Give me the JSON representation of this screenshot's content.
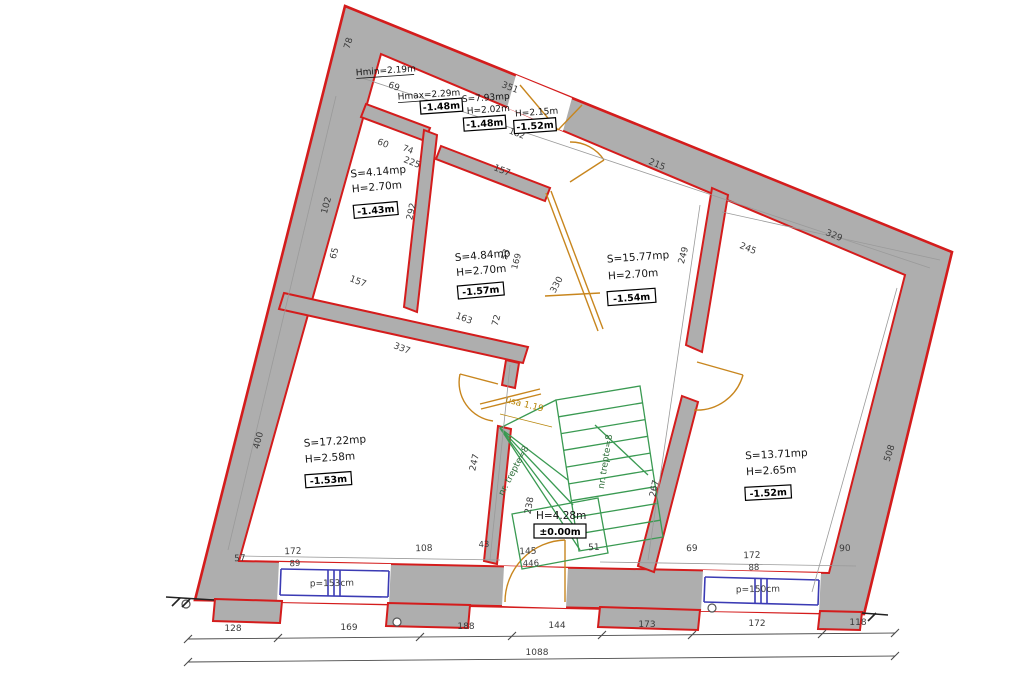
{
  "colors": {
    "wall_fill": "#aeaeae",
    "wall_outline": "#d41c1c",
    "stairs": "#3a9a52",
    "doors": "#c8861e",
    "windows": "#3b3bb4",
    "dimensions": "#3b3b3b"
  },
  "rooms": {
    "corridor": {
      "hmin": "Hmin=2.19m",
      "hmax": "Hmax=2.29m",
      "level_a": "-1.48m",
      "area": "S=7.93mp",
      "height": "H=2.02m",
      "level_b": "-1.48m",
      "height_b": "H=2.15m",
      "level_c": "-1.52m"
    },
    "small_left": {
      "area": "S=4.14mp",
      "height": "H=2.70m",
      "level": "-1.43m"
    },
    "small_mid": {
      "area": "S=4.84mp",
      "height": "H=2.70m",
      "level": "-1.57m"
    },
    "center": {
      "area": "S=15.77mp",
      "height": "H=2.70m",
      "level": "-1.54m"
    },
    "big_left": {
      "area": "S=17.22mp",
      "height": "H=2.58m",
      "level": "-1.53m"
    },
    "big_right": {
      "area": "S=13.71mp",
      "height": "H=2.65m",
      "level": "-1.52m"
    }
  },
  "stairs": {
    "treads_label_a": "nr. trepte=8",
    "treads_label_b": "nr. trepte=8",
    "height": "H=4.28m",
    "level": "±0.00m",
    "door_label": "usa 1.19"
  },
  "windows": {
    "left_parapet": "p=153cm",
    "right_parapet": "p=150cm"
  },
  "dim_chain_bottom": {
    "segments": [
      "128",
      "169",
      "188",
      "144",
      "173",
      "172",
      "118"
    ],
    "total": "1088"
  },
  "dims": {
    "t78": "78",
    "t69": "69",
    "t351": "351",
    "t60": "60",
    "t74": "74",
    "t225": "225",
    "t157_top": "157",
    "t182": "182",
    "t215": "215",
    "t245": "245",
    "t329": "329",
    "l102": "102",
    "l65": "65",
    "l292": "292",
    "l400": "400",
    "m157_bottom": "157",
    "m337": "337",
    "m247": "247",
    "m163": "163",
    "m72": "72",
    "m53": "53",
    "m169": "169",
    "m330": "330",
    "m238": "238",
    "m249": "249",
    "m267": "267",
    "r508": "508",
    "b57": "57",
    "b172_left": "172",
    "b89": "89",
    "b108": "108",
    "b43": "43",
    "b145": "145",
    "b446": "446",
    "b51": "51",
    "b69": "69",
    "b172_right": "172",
    "b88": "88",
    "b90": "90"
  }
}
